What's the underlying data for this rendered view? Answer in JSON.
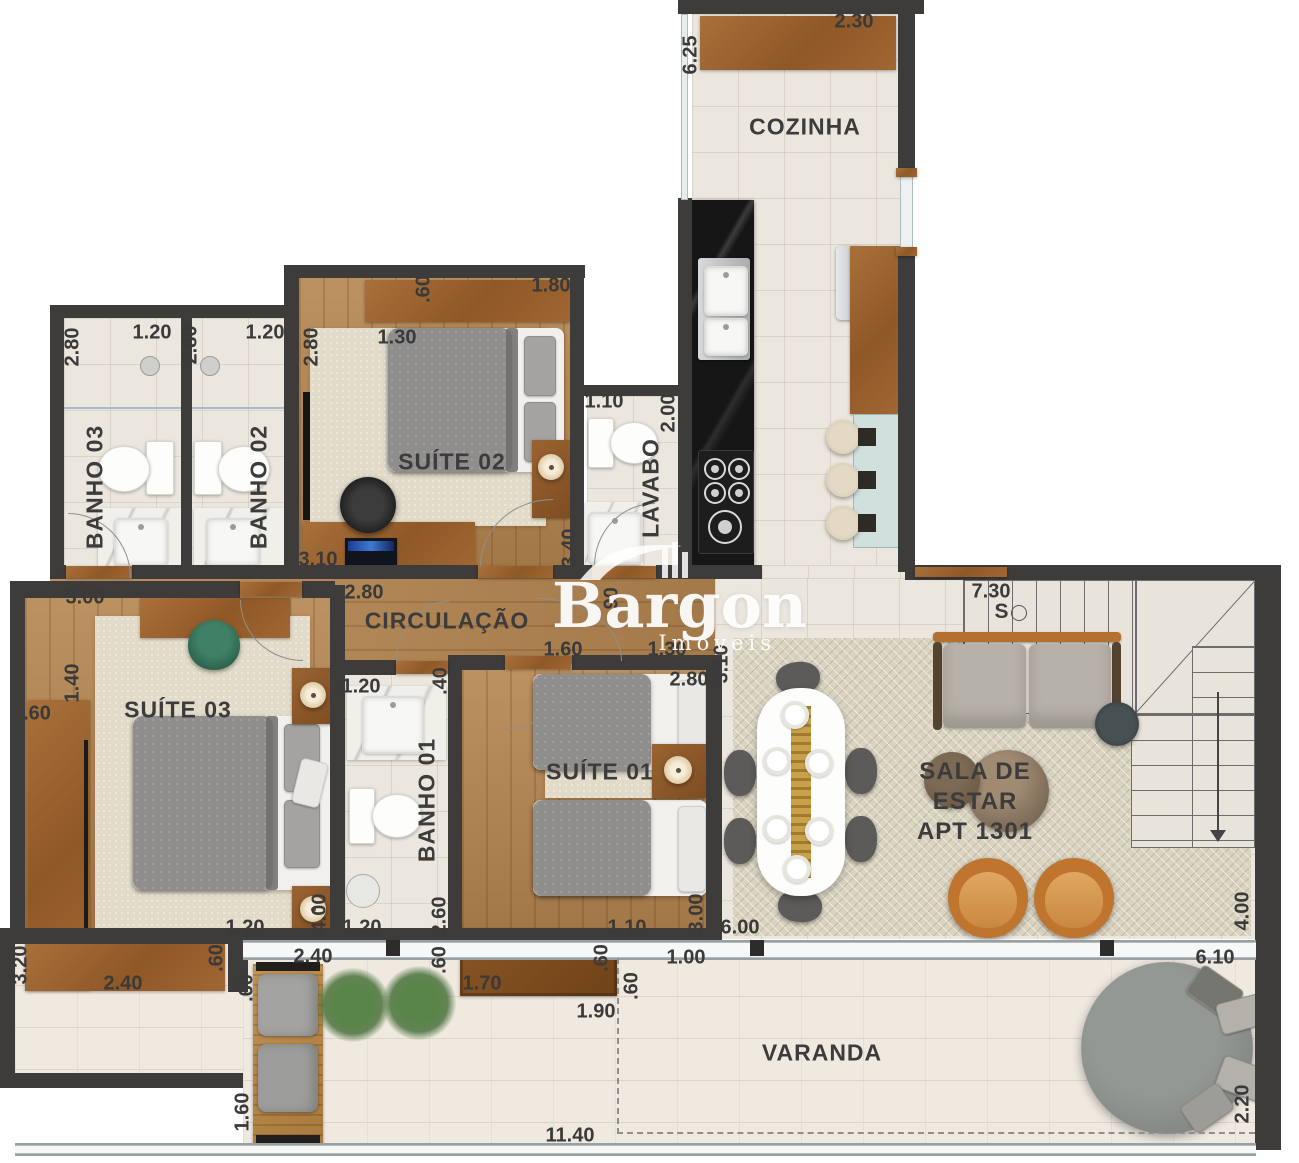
{
  "plan": {
    "apartment_label": "APT 1301",
    "logo": {
      "name": "Bargon",
      "tagline": "Imóveis"
    },
    "room_labels": [
      {
        "t": "COZINHA",
        "x": 805,
        "y": 127
      },
      {
        "t": "BANHO 03",
        "x": 95,
        "y": 487,
        "v": true
      },
      {
        "t": "BANHO 02",
        "x": 259,
        "y": 487,
        "v": true
      },
      {
        "t": "SUÍTE 02",
        "x": 452,
        "y": 462
      },
      {
        "t": "LAVABO",
        "x": 651,
        "y": 488,
        "v": true
      },
      {
        "t": "CIRCULAÇÃO",
        "x": 447,
        "y": 621
      },
      {
        "t": "SUÍTE 03",
        "x": 178,
        "y": 710
      },
      {
        "t": "BANHO 01",
        "x": 427,
        "y": 800,
        "v": true
      },
      {
        "t": "SUÍTE 01",
        "x": 600,
        "y": 772
      },
      {
        "t": "SALA DE\nESTAR\nAPT 1301",
        "x": 975,
        "y": 802,
        "fs": 24
      },
      {
        "t": "VARANDA",
        "x": 822,
        "y": 1053
      },
      {
        "t": "S",
        "x": 1002,
        "y": 612,
        "fs": 21
      }
    ],
    "dimensions": [
      {
        "t": "6.25",
        "x": 691,
        "y": 55,
        "v": true
      },
      {
        "t": "2.30",
        "x": 854,
        "y": 22
      },
      {
        "t": "2.80",
        "x": 73,
        "y": 347,
        "v": true
      },
      {
        "t": "1.20",
        "x": 152,
        "y": 333
      },
      {
        "t": "2.80",
        "x": 191,
        "y": 345,
        "v": true
      },
      {
        "t": "1.20",
        "x": 265,
        "y": 333
      },
      {
        "t": "2.80",
        "x": 312,
        "y": 347,
        "v": true
      },
      {
        "t": ".60",
        "x": 424,
        "y": 289,
        "v": true
      },
      {
        "t": "1.80",
        "x": 551,
        "y": 286
      },
      {
        "t": "1.30",
        "x": 397,
        "y": 338
      },
      {
        "t": "1.10",
        "x": 604,
        "y": 402
      },
      {
        "t": "2.00",
        "x": 669,
        "y": 413,
        "v": true
      },
      {
        "t": "3.40",
        "x": 570,
        "y": 548,
        "v": true
      },
      {
        "t": "3.10",
        "x": 318,
        "y": 560
      },
      {
        "t": "2.80",
        "x": 364,
        "y": 593
      },
      {
        "t": "3.00",
        "x": 85,
        "y": 598
      },
      {
        "t": ".90",
        "x": 612,
        "y": 601,
        "v": true
      },
      {
        "t": "7.30",
        "x": 991,
        "y": 592
      },
      {
        "t": "1.40",
        "x": 73,
        "y": 683,
        "v": true
      },
      {
        "t": ".60",
        "x": 37,
        "y": 714
      },
      {
        "t": "1.20",
        "x": 361,
        "y": 687
      },
      {
        "t": ".40",
        "x": 441,
        "y": 681,
        "v": true
      },
      {
        "t": "1.60",
        "x": 563,
        "y": 650
      },
      {
        "t": "1.30",
        "x": 667,
        "y": 650
      },
      {
        "t": "2.80",
        "x": 689,
        "y": 680
      },
      {
        "t": "3.10",
        "x": 722,
        "y": 664,
        "v": true
      },
      {
        "t": "1.20",
        "x": 245,
        "y": 928
      },
      {
        "t": "4.00",
        "x": 320,
        "y": 913,
        "v": true
      },
      {
        "t": "1.20",
        "x": 362,
        "y": 928
      },
      {
        "t": "2.60",
        "x": 440,
        "y": 916,
        "v": true
      },
      {
        "t": "1.10",
        "x": 627,
        "y": 928
      },
      {
        "t": "3.00",
        "x": 697,
        "y": 913,
        "v": true
      },
      {
        "t": "6.00",
        "x": 740,
        "y": 928
      },
      {
        "t": "4.00",
        "x": 1243,
        "y": 911,
        "v": true
      },
      {
        "t": "3.20",
        "x": 21,
        "y": 965,
        "v": true
      },
      {
        "t": "2.40",
        "x": 123,
        "y": 984
      },
      {
        "t": ".60",
        "x": 217,
        "y": 958,
        "v": true
      },
      {
        "t": "2.40",
        "x": 313,
        "y": 957
      },
      {
        "t": ".60",
        "x": 247,
        "y": 988,
        "v": true
      },
      {
        "t": "1.60",
        "x": 243,
        "y": 1112,
        "v": true
      },
      {
        "t": ".60",
        "x": 440,
        "y": 960,
        "v": true
      },
      {
        "t": "1.70",
        "x": 482,
        "y": 984
      },
      {
        "t": ".60",
        "x": 602,
        "y": 958,
        "v": true
      },
      {
        "t": "1.90",
        "x": 596,
        "y": 1012
      },
      {
        "t": ".60",
        "x": 632,
        "y": 986,
        "v": true
      },
      {
        "t": "1.00",
        "x": 686,
        "y": 958
      },
      {
        "t": "11.40",
        "x": 570,
        "y": 1136
      },
      {
        "t": "6.10",
        "x": 1215,
        "y": 958
      },
      {
        "t": "2.20",
        "x": 1243,
        "y": 1104,
        "v": true
      }
    ]
  }
}
